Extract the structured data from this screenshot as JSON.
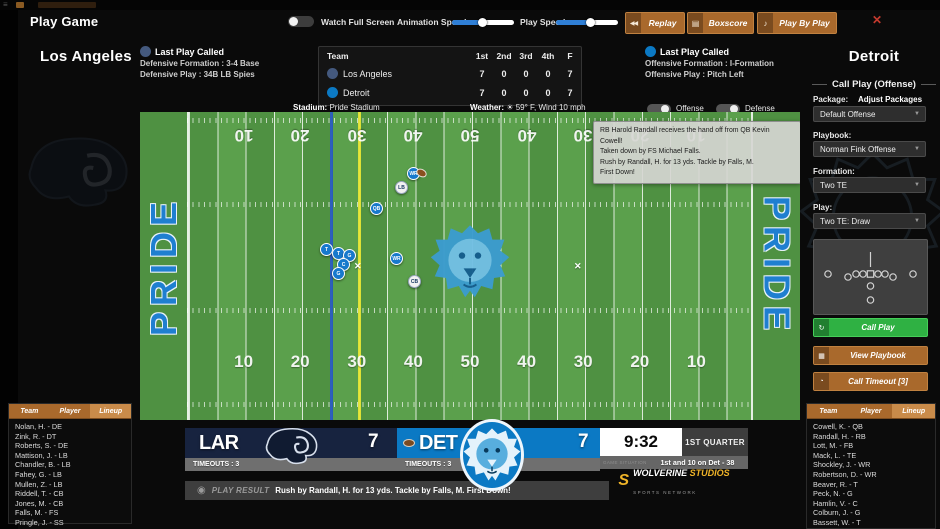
{
  "header": {
    "title": "Play Game",
    "watch_full_screen": "Watch Full Screen",
    "animation_speed": "Animation Speed",
    "animation_speed_pct": 48,
    "play_speed": "Play Speed",
    "play_speed_pct": 55,
    "replay": "Replay",
    "replay_icon": "◀◀",
    "boxscore": "Boxscore",
    "boxscore_icon": "▤",
    "play_by_play": "Play By Play",
    "play_by_play_icon": "♪",
    "close_icon": "✕"
  },
  "colors": {
    "accent_orange": "#a9692c",
    "accent_green": "#2fb143",
    "slider_blue": "#2f7fd6",
    "field_green": "#529644",
    "endzone_blue": "#1f7fd0",
    "lar_navy": "#17233f",
    "det_blue": "#0b79c4"
  },
  "away": {
    "city": "Los Angeles",
    "abbr": "LAR",
    "score": "7",
    "timeouts": "TIMEOUTS : 3",
    "last_play_title": "Last Play Called",
    "last_play_line1": "Defensive Formation : 3-4 Base",
    "last_play_line2": "Defensive Play : 34B LB Spies"
  },
  "home": {
    "city": "Detroit",
    "abbr": "DET",
    "score": "7",
    "timeouts": "TIMEOUTS : 3",
    "last_play_title": "Last Play Called",
    "last_play_line1": "Offensive Formation : I-Formation",
    "last_play_line2": "Offensive Play : Pitch Left"
  },
  "score_table": {
    "headers": [
      "Team",
      "1st",
      "2nd",
      "3rd",
      "4th",
      "F"
    ],
    "rows": [
      {
        "team": "Los Angeles",
        "logo": "ram",
        "scores": [
          "7",
          "0",
          "0",
          "0",
          "7"
        ]
      },
      {
        "team": "Detroit",
        "logo": "lion",
        "scores": [
          "7",
          "0",
          "0",
          "0",
          "7"
        ]
      }
    ]
  },
  "field": {
    "stadium_label": "Stadium:",
    "stadium_value": "Pride Stadium",
    "weather_label": "Weather:",
    "weather_icon": "☀",
    "weather_value": "59° F, Wind 10 mph",
    "offense_toggle": "Offense",
    "defense_toggle": "Defense",
    "endzone_text": "PRIDE",
    "yard_numbers": [
      "10",
      "20",
      "30",
      "40",
      "50",
      "40",
      "30",
      "20",
      "10"
    ],
    "blue_line_x": 190,
    "yellow_line_x": 218,
    "tooltip_lines": [
      "RB Harold Randall receives the hand off from QB Kevin Cowell!",
      "Taken down by FS Michael Falls.",
      "Rush by Randall, H. for 13 yds. Tackle by Falls, M.",
      "First Down!"
    ],
    "players": [
      {
        "label": "WR",
        "side": "off",
        "x": 267,
        "y": 55
      },
      {
        "label": "LB",
        "side": "def",
        "x": 255,
        "y": 69
      },
      {
        "label": "QB",
        "side": "off",
        "x": 230,
        "y": 90
      },
      {
        "label": "T",
        "side": "off",
        "x": 180,
        "y": 131
      },
      {
        "label": "T",
        "side": "off",
        "x": 192,
        "y": 135
      },
      {
        "label": "G",
        "side": "off",
        "x": 203,
        "y": 137
      },
      {
        "label": "C",
        "side": "off",
        "x": 197,
        "y": 146
      },
      {
        "label": "G",
        "side": "off",
        "x": 192,
        "y": 155
      },
      {
        "label": "WR",
        "side": "off",
        "x": 250,
        "y": 140
      },
      {
        "label": "CB",
        "side": "def",
        "x": 268,
        "y": 163
      }
    ],
    "ball": {
      "x": 276,
      "y": 57
    },
    "x_marks": [
      {
        "x": 214,
        "y": 149
      },
      {
        "x": 434,
        "y": 149
      }
    ]
  },
  "sidebar": {
    "title": "Call Play (Offense)",
    "package_label": "Package:",
    "adjust_packages": "Adjust Packages",
    "package_value": "Default Offense",
    "playbook_label": "Playbook:",
    "playbook_value": "Norman Fink Offense",
    "formation_label": "Formation:",
    "formation_value": "Two TE",
    "play_label": "Play:",
    "play_value": "Two TE: Draw",
    "call_play": "Call Play",
    "call_play_icon": "↻",
    "view_playbook": "View Playbook",
    "view_playbook_icon": "▦",
    "call_timeout": "Call Timeout [3]",
    "call_timeout_icon": "◔",
    "caret_icon": "▼"
  },
  "rosters": {
    "tabs": [
      "Team",
      "Player",
      "Lineup"
    ],
    "active_tab": "Lineup",
    "away_players": [
      "Nolan, H. - DE",
      "Zink, R. - DT",
      "Roberts, S. - DE",
      "Mattison, J. - LB",
      "Chandler, B. - LB",
      "Fahey, G. - LB",
      "Mullen, Z. - LB",
      "Riddell, T. - CB",
      "Jones, M. - CB",
      "Falls, M. - FS",
      "Pringle, J. - SS"
    ],
    "home_players": [
      "Cowell, K. - QB",
      "Randall, H. - RB",
      "Lott, M. - FB",
      "Mack, L. - TE",
      "Shockley, J. - WR",
      "Robertson, D. - WR",
      "Beaver, R. - T",
      "Peck, N. - G",
      "Hamlin, V. - C",
      "Colburn, J. - G",
      "Bassett, W. - T"
    ]
  },
  "scoreboard": {
    "clock": "9:32",
    "quarter": "1ST QUARTER",
    "situation_watermark": "GAME SITUATION",
    "situation": "1st and 10 on Det - 38",
    "network_s": "S",
    "network_name": "WOLVERINE ",
    "network_name2": "STUDIOS",
    "network_sub": "SPORTS NETWORK",
    "play_result_label": "PLAY RESULT",
    "play_result_text": "Rush by Randall, H. for 13 yds. Tackle by Falls, M. First Down!",
    "whistle_icon": "◉"
  }
}
